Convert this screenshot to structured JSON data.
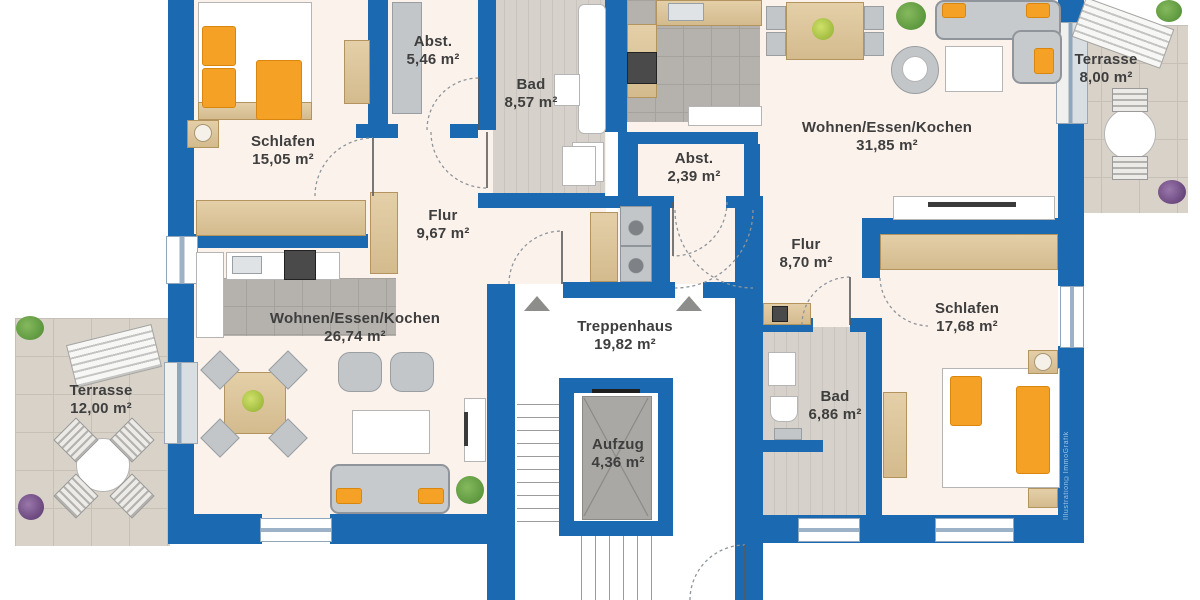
{
  "watermark": "Illustration©ImmoGrafik",
  "area_unit": "m²",
  "colors": {
    "wall_blue": "#1b69b0",
    "accent_orange": "#f4a126",
    "floor_cream": "#fcf2ec"
  },
  "rooms": [
    {
      "id": "schlafen-left",
      "name": "Schlafen",
      "area": "15,05 m²"
    },
    {
      "id": "abst-left",
      "name": "Abst.",
      "area": "5,46 m²"
    },
    {
      "id": "bad-left",
      "name": "Bad",
      "area": "8,57 m²"
    },
    {
      "id": "flur-left",
      "name": "Flur",
      "area": "9,67 m²"
    },
    {
      "id": "wohnen-left",
      "name": "Wohnen/Essen/Kochen",
      "area": "26,74 m²"
    },
    {
      "id": "terrasse-left",
      "name": "Terrasse",
      "area": "12,00 m²"
    },
    {
      "id": "treppenhaus",
      "name": "Treppenhaus",
      "area": "19,82 m²"
    },
    {
      "id": "aufzug",
      "name": "Aufzug",
      "area": "4,36 m²"
    },
    {
      "id": "abst-right",
      "name": "Abst.",
      "area": "2,39 m²"
    },
    {
      "id": "wohnen-right",
      "name": "Wohnen/Essen/Kochen",
      "area": "31,85 m²"
    },
    {
      "id": "flur-right",
      "name": "Flur",
      "area": "8,70 m²"
    },
    {
      "id": "schlafen-right",
      "name": "Schlafen",
      "area": "17,68 m²"
    },
    {
      "id": "bad-right",
      "name": "Bad",
      "area": "6,86 m²"
    },
    {
      "id": "terrasse-right",
      "name": "Terrasse",
      "area": "8,00 m²"
    }
  ]
}
